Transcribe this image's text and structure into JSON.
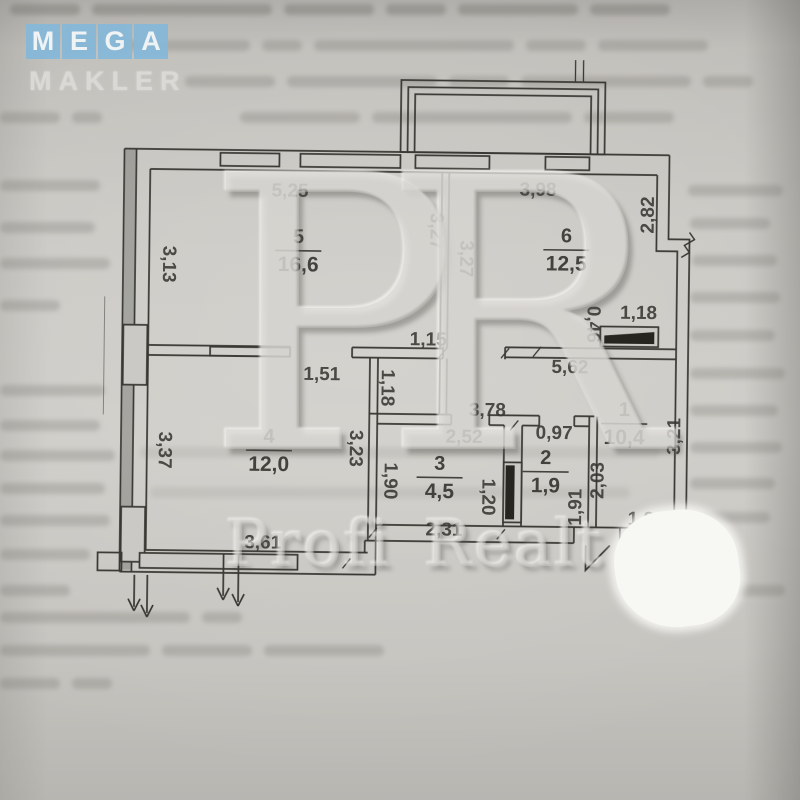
{
  "logo": {
    "tiles": [
      {
        "letter": "M"
      },
      {
        "letter": "E"
      },
      {
        "letter": "G"
      },
      {
        "letter": "A"
      }
    ],
    "subtitle": "MAKLER",
    "tile_color": "#87b8d9"
  },
  "watermark": {
    "monogram": "PR",
    "brand": "Profi Realt"
  },
  "plan": {
    "rooms": [
      {
        "number": "5",
        "area": "16,6",
        "cx": 297,
        "cy": 252
      },
      {
        "number": "6",
        "area": "12,5",
        "cx": 565,
        "cy": 248
      },
      {
        "number": "4",
        "area": "12,0",
        "cx": 270,
        "cy": 452
      },
      {
        "number": "3",
        "area": "4,5",
        "cx": 441,
        "cy": 477
      },
      {
        "number": "2",
        "area": "1,9",
        "cx": 547,
        "cy": 470
      },
      {
        "number": "1",
        "area": "10,4",
        "cx": 625,
        "cy": 421
      }
    ],
    "dimensions": [
      {
        "text": "5,25",
        "x": 288,
        "y": 193,
        "rot": 0
      },
      {
        "text": "3,98",
        "x": 536,
        "y": 189,
        "rot": 0
      },
      {
        "text": "2,82",
        "x": 647,
        "y": 212,
        "rot": -90
      },
      {
        "text": "3,13",
        "x": 167,
        "y": 267,
        "rot": 90
      },
      {
        "text": "3,27",
        "x": 434,
        "y": 231,
        "rot": 90
      },
      {
        "text": "3,27",
        "x": 464,
        "y": 258,
        "rot": 90
      },
      {
        "text": "1,15",
        "x": 428,
        "y": 340,
        "rot": 0
      },
      {
        "text": "5,62",
        "x": 570,
        "y": 366,
        "rot": 0
      },
      {
        "text": "0,46",
        "x": 592,
        "y": 322,
        "rot": 90
      },
      {
        "text": "1,18",
        "x": 638,
        "y": 311,
        "rot": 0
      },
      {
        "text": "1,51",
        "x": 322,
        "y": 376,
        "rot": 0
      },
      {
        "text": "1,18",
        "x": 387,
        "y": 388,
        "rot": 90
      },
      {
        "text": "3,78",
        "x": 488,
        "y": 410,
        "rot": 0
      },
      {
        "text": "2,52",
        "x": 465,
        "y": 437,
        "rot": 0
      },
      {
        "text": "0,97",
        "x": 555,
        "y": 432,
        "rot": 0
      },
      {
        "text": "3,23",
        "x": 356,
        "y": 449,
        "rot": 90
      },
      {
        "text": "1,90",
        "x": 391,
        "y": 481,
        "rot": 90
      },
      {
        "text": "1,20",
        "x": 489,
        "y": 496,
        "rot": 90
      },
      {
        "text": "1,91",
        "x": 578,
        "y": 505,
        "rot": -90
      },
      {
        "text": "2,03",
        "x": 600,
        "y": 478,
        "rot": -90
      },
      {
        "text": "3,21",
        "x": 676,
        "y": 433,
        "rot": -90
      },
      {
        "text": "2,31",
        "x": 446,
        "y": 530,
        "rot": 0
      },
      {
        "text": "1,84",
        "x": 648,
        "y": 517,
        "rot": 0
      },
      {
        "text": "3,37",
        "x": 165,
        "y": 453,
        "rot": 90
      },
      {
        "text": "3,61",
        "x": 265,
        "y": 545,
        "rot": 0
      }
    ]
  }
}
